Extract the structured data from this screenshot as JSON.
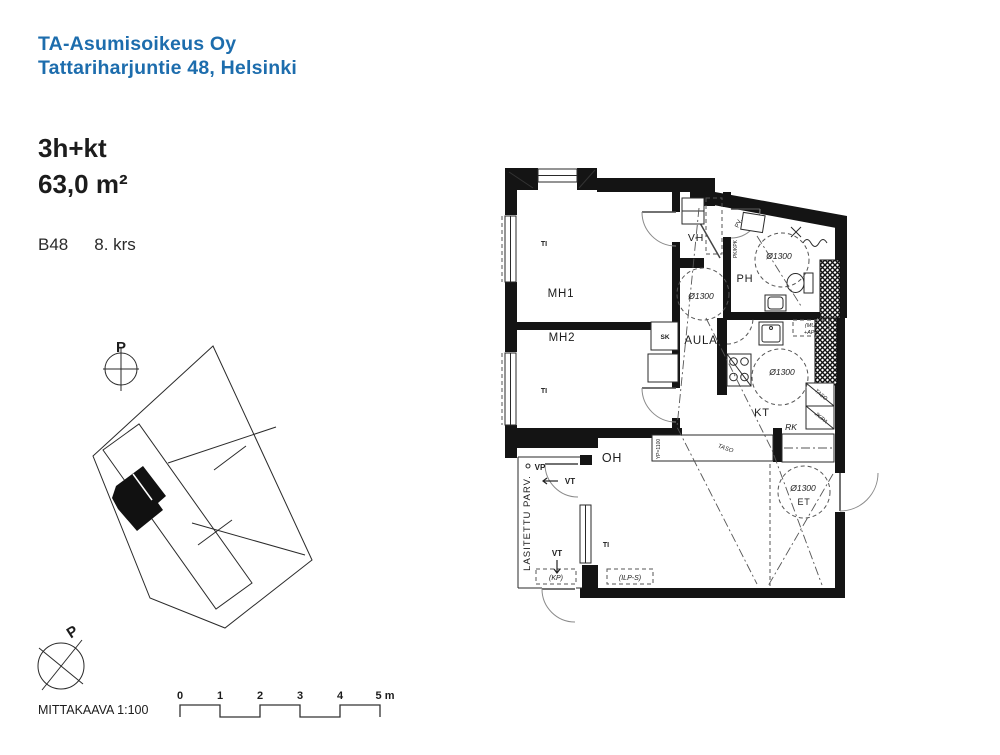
{
  "header": {
    "company": "TA-Asumisoikeus Oy",
    "address": "Tattariharjuntie 48, Helsinki",
    "apartment_type": "3h+kt",
    "area": "63,0 m²",
    "apartment_id": "B48",
    "floor": "8. krs"
  },
  "floor_plan": {
    "rooms": {
      "mh1": "MH1",
      "mh2": "MH2",
      "vh": "VH",
      "ph": "PH",
      "aula": "AULA",
      "kt": "KT",
      "oh": "OH",
      "et": "ET"
    },
    "balcony_label": "LASITETTU PARV.",
    "annotations": {
      "turning_circle": "Ø1300",
      "window": "TI",
      "cleaning_cabinet": "SK",
      "distribution_board": "RK",
      "water_point": "VP",
      "vent": "VT",
      "laundry": "PV.",
      "washer_reservation": "PK/KPK",
      "microwave": "(MU)",
      "dishwasher": "+APK",
      "counter": "TASO",
      "fridge_freezer": "JK/PA",
      "counter_height": "YP=1100",
      "kp": "(KP)",
      "ilps": "(ILP-S)"
    }
  },
  "site_plan": {
    "north_label": "P"
  },
  "scale_bar": {
    "label": "MITTAKAAVA 1:100",
    "ticks": [
      "0",
      "1",
      "2",
      "3",
      "4"
    ],
    "end_tick": "5 m"
  },
  "colors": {
    "brand_blue": "#1d6dad",
    "ink": "#1c1c1c"
  }
}
